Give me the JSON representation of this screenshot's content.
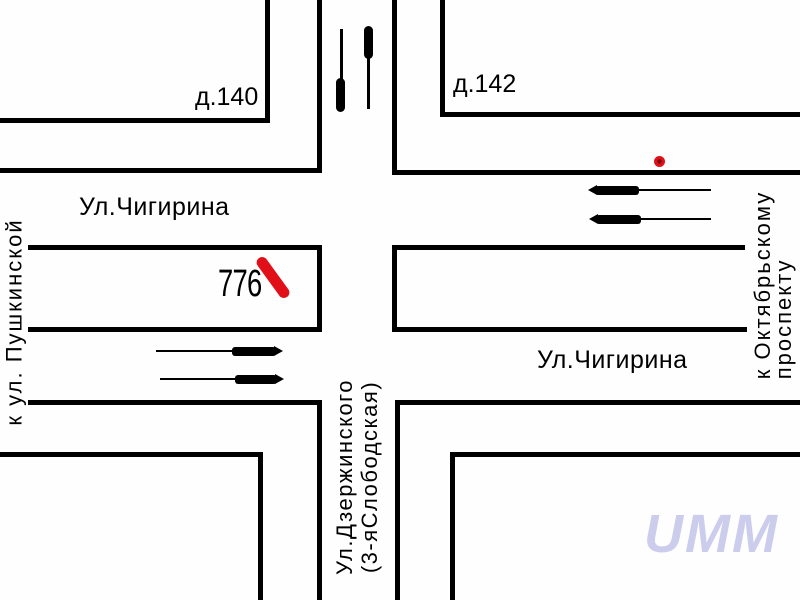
{
  "title": "Схема перекрёстка",
  "streets": {
    "horizontal_west_label": "Ул.Чигирина",
    "horizontal_east_label": "Ул.Чигирина",
    "vertical_label": "Ул.Дзержинского\n(3-яСлободская)"
  },
  "directions": {
    "left": "к ул. Пушкинской",
    "right": "к Октябрьскому\nпроспекту"
  },
  "buildings": {
    "top_left": "д.140",
    "top_right": "д.142"
  },
  "route": {
    "number": "776"
  },
  "watermark": "UMM",
  "icons": {
    "route_marker": "red-route-segment-marker",
    "stop_dot": "red-stop-dot",
    "lane_marker_left": "lane-arrow-down",
    "lane_marker_right": "lane-arrow-up",
    "east_arrows": "direction-arrow-left",
    "west_arrows": "direction-arrow-right"
  },
  "colors": {
    "road": "#000000",
    "marker_red": "#e11018",
    "watermark_text": "#ccccec",
    "background": "#fefefe"
  }
}
